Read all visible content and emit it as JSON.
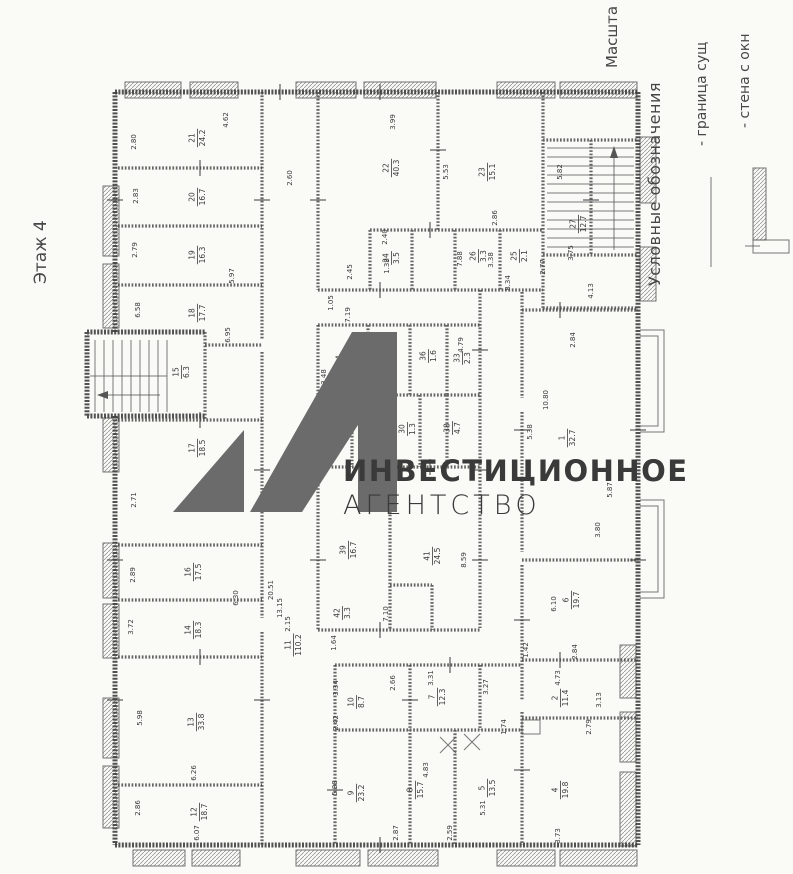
{
  "page": {
    "title": "Этаж 4",
    "scale_label": "Масшта"
  },
  "watermark": {
    "line1": "ИНВЕСТИЦИОННОЕ",
    "line2": "АГЕНТСТВО",
    "logo_color": "#6b6b6b",
    "line1_color": "#5d6165",
    "line2_color": "#b6babd"
  },
  "legend": {
    "header": "Условные обозначения",
    "items": [
      {
        "label": "- граница сущ",
        "symbol": "boundary-line"
      },
      {
        "label": "- стена с окн",
        "symbol": "wall-with-window"
      }
    ]
  },
  "colors": {
    "paper": "#fafaf7",
    "ink": "#3e3e3e"
  },
  "rooms": [
    {
      "n": "21",
      "a": "24.2",
      "x": 197,
      "y": 138
    },
    {
      "n": "20",
      "a": "16.7",
      "x": 197,
      "y": 197
    },
    {
      "n": "19",
      "a": "16.3",
      "x": 197,
      "y": 255
    },
    {
      "n": "18",
      "a": "17.7",
      "x": 197,
      "y": 313
    },
    {
      "n": "15",
      "a": "6.3",
      "x": 181,
      "y": 372
    },
    {
      "n": "17",
      "a": "18.5",
      "x": 197,
      "y": 448
    },
    {
      "n": "16",
      "a": "17.5",
      "x": 193,
      "y": 572
    },
    {
      "n": "14",
      "a": "18.3",
      "x": 193,
      "y": 630
    },
    {
      "n": "13",
      "a": "33.8",
      "x": 196,
      "y": 722
    },
    {
      "n": "12",
      "a": "18.7",
      "x": 199,
      "y": 812
    },
    {
      "n": "22",
      "a": "40.3",
      "x": 391,
      "y": 168
    },
    {
      "n": "23",
      "a": "15.1",
      "x": 487,
      "y": 172
    },
    {
      "n": "24",
      "a": "3.5",
      "x": 391,
      "y": 258
    },
    {
      "n": "26",
      "a": "3.3",
      "x": 478,
      "y": 256
    },
    {
      "n": "25",
      "a": "2.1",
      "x": 519,
      "y": 256
    },
    {
      "n": "27",
      "a": "12.7",
      "x": 578,
      "y": 224
    },
    {
      "n": "34",
      "a": "4.6",
      "x": 344,
      "y": 360
    },
    {
      "n": "35",
      "a": "3.2",
      "x": 388,
      "y": 358
    },
    {
      "n": "36",
      "a": "1.6",
      "x": 428,
      "y": 356
    },
    {
      "n": "33",
      "a": "2.3",
      "x": 462,
      "y": 358
    },
    {
      "n": "28",
      "a": "3.1",
      "x": 336,
      "y": 427
    },
    {
      "n": "37",
      "a": "3.3",
      "x": 372,
      "y": 429
    },
    {
      "n": "30",
      "a": "1.3",
      "x": 407,
      "y": 429
    },
    {
      "n": "38",
      "a": "4.7",
      "x": 452,
      "y": 428
    },
    {
      "n": "39",
      "a": "16.7",
      "x": 348,
      "y": 550
    },
    {
      "n": "41",
      "a": "24.5",
      "x": 432,
      "y": 556
    },
    {
      "n": "42",
      "a": "3.3",
      "x": 342,
      "y": 613
    },
    {
      "n": "11",
      "a": "110.2",
      "x": 293,
      "y": 645
    },
    {
      "n": "1",
      "a": "32.7",
      "x": 567,
      "y": 438
    },
    {
      "n": "6",
      "a": "19.7",
      "x": 571,
      "y": 600
    },
    {
      "n": "2",
      "a": "11.4",
      "x": 560,
      "y": 698
    },
    {
      "n": "4",
      "a": "19.8",
      "x": 560,
      "y": 790
    },
    {
      "n": "5",
      "a": "13.5",
      "x": 487,
      "y": 788
    },
    {
      "n": "7",
      "a": "12.3",
      "x": 437,
      "y": 697
    },
    {
      "n": "8",
      "a": "15.7",
      "x": 415,
      "y": 790
    },
    {
      "n": "10",
      "a": "8.7",
      "x": 356,
      "y": 702
    },
    {
      "n": "9",
      "a": "23.2",
      "x": 356,
      "y": 793
    }
  ],
  "dimensions": [
    {
      "t": "2.80",
      "x": 136,
      "y": 142
    },
    {
      "t": "2.83",
      "x": 138,
      "y": 196
    },
    {
      "t": "2.79",
      "x": 137,
      "y": 250
    },
    {
      "t": "6.58",
      "x": 140,
      "y": 310
    },
    {
      "t": "2.71",
      "x": 136,
      "y": 500
    },
    {
      "t": "2.89",
      "x": 135,
      "y": 575
    },
    {
      "t": "3.72",
      "x": 133,
      "y": 627
    },
    {
      "t": "5.98",
      "x": 142,
      "y": 718
    },
    {
      "t": "2.86",
      "x": 140,
      "y": 808
    },
    {
      "t": "4.62",
      "x": 228,
      "y": 120
    },
    {
      "t": "3.99",
      "x": 395,
      "y": 122
    },
    {
      "t": "5.53",
      "x": 448,
      "y": 172
    },
    {
      "t": "5.82",
      "x": 562,
      "y": 172
    },
    {
      "t": "2.86",
      "x": 497,
      "y": 218
    },
    {
      "t": "2.40",
      "x": 387,
      "y": 237
    },
    {
      "t": "1.39",
      "x": 389,
      "y": 266
    },
    {
      "t": "7.88",
      "x": 462,
      "y": 259
    },
    {
      "t": "3.38",
      "x": 493,
      "y": 260
    },
    {
      "t": "2.77",
      "x": 545,
      "y": 267
    },
    {
      "t": "3.75",
      "x": 573,
      "y": 253
    },
    {
      "t": "4.13",
      "x": 593,
      "y": 291
    },
    {
      "t": "8.34",
      "x": 510,
      "y": 283
    },
    {
      "t": "5.97",
      "x": 234,
      "y": 276
    },
    {
      "t": "2.60",
      "x": 292,
      "y": 178
    },
    {
      "t": "2.45",
      "x": 352,
      "y": 272
    },
    {
      "t": "1.05",
      "x": 333,
      "y": 303
    },
    {
      "t": "7.19",
      "x": 350,
      "y": 315
    },
    {
      "t": "6.95",
      "x": 230,
      "y": 335
    },
    {
      "t": "3.48",
      "x": 326,
      "y": 377
    },
    {
      "t": "4.79",
      "x": 463,
      "y": 345
    },
    {
      "t": "10.80",
      "x": 548,
      "y": 400
    },
    {
      "t": "5.38",
      "x": 532,
      "y": 432
    },
    {
      "t": "2.84",
      "x": 575,
      "y": 340
    },
    {
      "t": "3.80",
      "x": 600,
      "y": 530
    },
    {
      "t": "5.87",
      "x": 612,
      "y": 490
    },
    {
      "t": "6.10",
      "x": 556,
      "y": 604
    },
    {
      "t": "2.84",
      "x": 577,
      "y": 652
    },
    {
      "t": "4.73",
      "x": 560,
      "y": 678
    },
    {
      "t": "3.13",
      "x": 601,
      "y": 700
    },
    {
      "t": "2.79",
      "x": 591,
      "y": 727
    },
    {
      "t": "3.73",
      "x": 560,
      "y": 836
    },
    {
      "t": "1.42",
      "x": 528,
      "y": 650
    },
    {
      "t": "3.27",
      "x": 488,
      "y": 687
    },
    {
      "t": "1.74",
      "x": 506,
      "y": 727
    },
    {
      "t": "1.64",
      "x": 336,
      "y": 643
    },
    {
      "t": "13.15",
      "x": 282,
      "y": 608
    },
    {
      "t": "20.51",
      "x": 273,
      "y": 590
    },
    {
      "t": "2.15",
      "x": 290,
      "y": 624
    },
    {
      "t": "6.30",
      "x": 238,
      "y": 598
    },
    {
      "t": "3.31",
      "x": 433,
      "y": 678
    },
    {
      "t": "2.66",
      "x": 395,
      "y": 683
    },
    {
      "t": "3.34",
      "x": 338,
      "y": 688
    },
    {
      "t": "2.42",
      "x": 338,
      "y": 723
    },
    {
      "t": "5.38",
      "x": 337,
      "y": 788
    },
    {
      "t": "4.83",
      "x": 428,
      "y": 770
    },
    {
      "t": "5.31",
      "x": 485,
      "y": 808
    },
    {
      "t": "2.87",
      "x": 398,
      "y": 833
    },
    {
      "t": "2.59",
      "x": 452,
      "y": 833
    },
    {
      "t": "6.07",
      "x": 199,
      "y": 833
    },
    {
      "t": "6.26",
      "x": 196,
      "y": 773
    },
    {
      "t": "8.59",
      "x": 466,
      "y": 560
    },
    {
      "t": "7.10",
      "x": 388,
      "y": 614
    }
  ],
  "ticks": [
    {
      "x": 262,
      "y": 200,
      "o": "h"
    },
    {
      "x": 262,
      "y": 470,
      "o": "h"
    },
    {
      "x": 262,
      "y": 700,
      "o": "h"
    },
    {
      "x": 318,
      "y": 200,
      "o": "h"
    },
    {
      "x": 318,
      "y": 430,
      "o": "h"
    },
    {
      "x": 318,
      "y": 560,
      "o": "h"
    },
    {
      "x": 480,
      "y": 350,
      "o": "h"
    },
    {
      "x": 480,
      "y": 470,
      "o": "h"
    },
    {
      "x": 480,
      "y": 560,
      "o": "h"
    },
    {
      "x": 522,
      "y": 430,
      "o": "h"
    },
    {
      "x": 522,
      "y": 620,
      "o": "h"
    },
    {
      "x": 522,
      "y": 770,
      "o": "h"
    },
    {
      "x": 638,
      "y": 430,
      "o": "h"
    },
    {
      "x": 638,
      "y": 560,
      "o": "h"
    },
    {
      "x": 115,
      "y": 200,
      "o": "h"
    },
    {
      "x": 115,
      "y": 560,
      "o": "h"
    },
    {
      "x": 115,
      "y": 700,
      "o": "h"
    },
    {
      "x": 438,
      "y": 150,
      "o": "h"
    },
    {
      "x": 591,
      "y": 200,
      "o": "h"
    },
    {
      "x": 410,
      "y": 700,
      "o": "h"
    },
    {
      "x": 335,
      "y": 790,
      "o": "h"
    },
    {
      "x": 380,
      "y": 92,
      "o": "v"
    },
    {
      "x": 380,
      "y": 290,
      "o": "v"
    },
    {
      "x": 430,
      "y": 467,
      "o": "v"
    },
    {
      "x": 380,
      "y": 630,
      "o": "v"
    },
    {
      "x": 450,
      "y": 665,
      "o": "v"
    },
    {
      "x": 380,
      "y": 845,
      "o": "v"
    },
    {
      "x": 280,
      "y": 92,
      "o": "v"
    },
    {
      "x": 560,
      "y": 310,
      "o": "v"
    },
    {
      "x": 560,
      "y": 660,
      "o": "v"
    },
    {
      "x": 200,
      "y": 168,
      "o": "v"
    },
    {
      "x": 200,
      "y": 420,
      "o": "v"
    },
    {
      "x": 200,
      "y": 657,
      "o": "v"
    },
    {
      "x": 430,
      "y": 230,
      "o": "v"
    }
  ]
}
